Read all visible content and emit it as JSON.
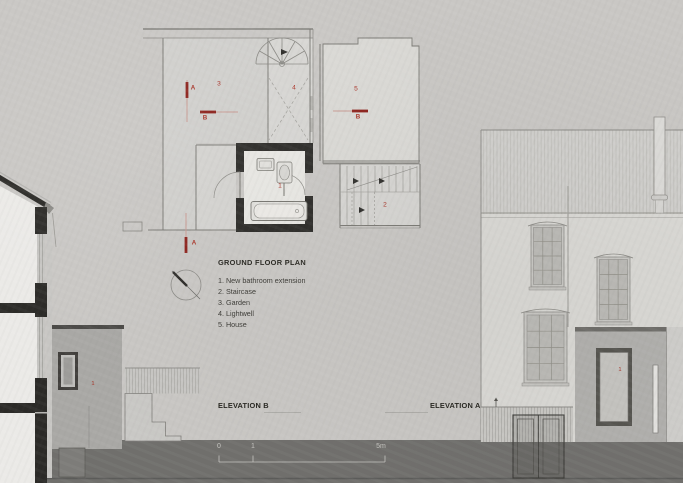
{
  "title": "GROUND FLOOR PLAN",
  "legend": {
    "items": [
      "1. New bathroom extension",
      "2. Staircase",
      "3. Garden",
      "4. Lightwell",
      "5. House"
    ]
  },
  "plan": {
    "rooms": {
      "bathroom": "1",
      "staircase": "2",
      "garden": "3",
      "lightwell": "4",
      "house": "5"
    }
  },
  "markers": {
    "a": "A",
    "b": "B"
  },
  "elevations": {
    "b": {
      "label": "ELEVATION B",
      "extension_tag": "1"
    },
    "a": {
      "label": "ELEVATION A",
      "extension_tag": "1"
    }
  },
  "scale_bar": {
    "labels": [
      "0",
      "1",
      "5m"
    ]
  },
  "colors": {
    "paper": "#c9c7c4",
    "ink": "#26251f",
    "accent-red": "#a93226",
    "accent-red-dark": "#8c201a",
    "accent-red-light": "#c89a92",
    "ground": "#706f6c",
    "wall-black": "#2b2a27"
  }
}
